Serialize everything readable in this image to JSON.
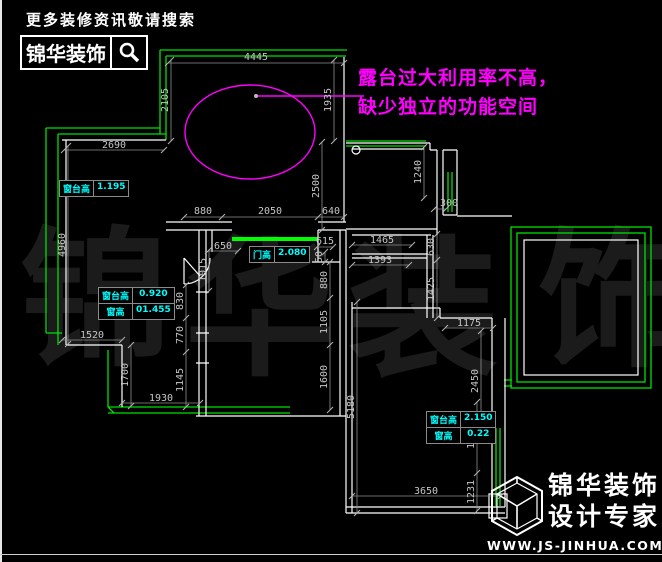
{
  "colors": {
    "background": "#000000",
    "wall": "#ffffff",
    "window_green": "#00e000",
    "annotation_magenta": "#ff00ff",
    "label_cyan": "#00ffff",
    "dimension_gray": "#c6c6c6",
    "watermark_gray": "#1b1b1b"
  },
  "header": {
    "tagline": "更多装修资讯敬请搜索",
    "brand": "锦华装饰"
  },
  "annotation": {
    "line1": "露台过大利用率不高，",
    "line2": "缺少独立的功能空间"
  },
  "watermark": {
    "char1": "锦",
    "char2": "华",
    "char3": "装",
    "char4": "饰"
  },
  "labels": {
    "sill_left": {
      "name": "窗台高",
      "value": "1.195"
    },
    "sill_mid": {
      "name": "窗台高",
      "value": "0.920"
    },
    "win_mid": {
      "name": "窗高",
      "value": "01.455"
    },
    "door": {
      "name": "门高",
      "value": "2.080"
    },
    "sill_br": {
      "name": "窗台高",
      "value": "2.150"
    },
    "win_br": {
      "name": "窗高",
      "value": "0.22"
    }
  },
  "dims": {
    "d4445": "4445",
    "d2690": "2690",
    "d2105": "2105",
    "d1935": "1935",
    "d2500": "2500",
    "d4960": "4960",
    "d880a": "880",
    "d2050": "2050",
    "d640": "640",
    "d650": "650",
    "d615": "615",
    "d50": "50",
    "d1015": "1015",
    "d830": "830",
    "d770": "770",
    "d1145": "1145",
    "d1520": "1520",
    "d1700": "1700",
    "d1930": "1930",
    "d880b": "880",
    "d1105": "1105",
    "d1600": "1600",
    "d1240": "1240",
    "d300": "300",
    "d1465": "1465",
    "d1393": "1393",
    "d630": "630",
    "d1425": "1425",
    "d1175": "1175",
    "d2450": "2450",
    "d5180": "5180",
    "d1750": "1750",
    "d1231": "1231",
    "d3650": "3650"
  },
  "footer": {
    "brand_line1": "锦华装饰",
    "brand_line2": "设计专家",
    "url": "WWW.JS-JINHUA.COM"
  }
}
